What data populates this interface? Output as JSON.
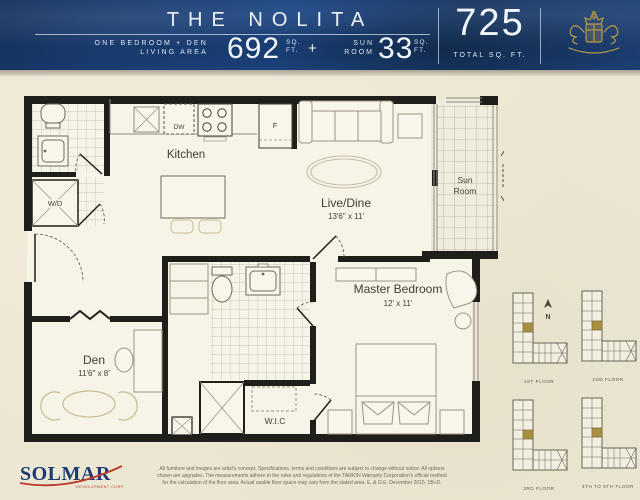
{
  "header": {
    "title": "THE NOLITA",
    "type_line1": "ONE BEDROOM + DEN",
    "type_line2": "LIVING AREA",
    "living_value": "692",
    "living_unit1": "SQ.",
    "living_unit2": "FT.",
    "plus_sign": "+",
    "sun_line1": "SUN",
    "sun_line2": "ROOM",
    "sun_value": "33",
    "sun_unit1": "SQ.",
    "sun_unit2": "FT.",
    "total_value": "725",
    "total_label": "TOTAL SQ. FT."
  },
  "floorplan": {
    "kitchen_label": "Kitchen",
    "livedine_label": "Live/Dine",
    "livedine_dims": "13'6\" x 11'",
    "sunroom_line1": "Sun",
    "sunroom_line2": "Room",
    "master_label": "Master Bedroom",
    "master_dims": "12' x 11'",
    "den_label": "Den",
    "den_dims": "11'6\" x 8'",
    "wic_label": "W.I.C",
    "wd_label": "W/D",
    "dw_label": "DW",
    "fridge_label": "F"
  },
  "keyplans": {
    "compass": "N",
    "plans": [
      {
        "label": "1ST FLOOR"
      },
      {
        "label": "2ND FLOOR"
      },
      {
        "label": "3RD FLOOR"
      },
      {
        "label": "4TH TO 8TH FLOOR"
      }
    ]
  },
  "footer": {
    "logo_text": "SOLMAR",
    "logo_subtext": "DEVELOPMENT CORP",
    "disclaimer_line1": "All furniture and images are artist's concept.  Specifications, terms and conditions are subject to change without notice.  All options",
    "disclaimer_line2": "shown are upgrades.  The measurements adhere to the rules and regulations of the TARION Warranty Corporation's official method",
    "disclaimer_line3": "for the calculation of the floor area.  Actual usable floor space may vary from the stated area.   E. & O.E.  December 2015.  1B+D."
  },
  "colors": {
    "header_navy": "#1d4076",
    "page_cream": "#ece7d3",
    "crest_gold": "#b79b42",
    "wall_black": "#201e1a",
    "keyplan_gold": "#a98e3d",
    "logo_navy": "#1c3a72",
    "logo_red": "#bb3a2e"
  }
}
